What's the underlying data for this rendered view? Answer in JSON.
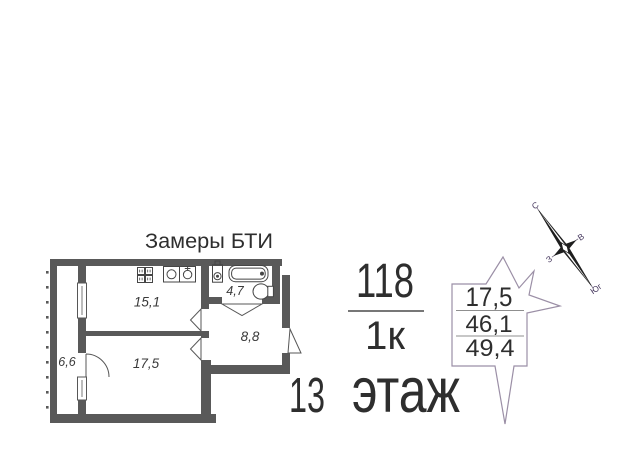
{
  "header": {
    "title": "Замеры БТИ"
  },
  "apartment": {
    "number": "118",
    "layout": "1к",
    "floor_number": "13",
    "floor_word": "этаж"
  },
  "rooms": {
    "kitchen_area": "15,1",
    "living_area": "17,5",
    "hall_area": "8,8",
    "bathroom_area": "4,7",
    "balcony_area": "6,6"
  },
  "area_stamp": {
    "living_area": "17,5",
    "apartment_area": "46,1",
    "total_area": "49,4"
  },
  "compass": {
    "north": "С",
    "east": "В",
    "west": "З",
    "south": "Юг"
  },
  "colors": {
    "wall": "#595959",
    "ink": "#2e2e2e",
    "room_label": "#3a3a3a",
    "fixture": "#454545",
    "stamp_outline": "#9b8fa6",
    "stamp_line": "#8f8f8f",
    "compass_needle": "#1e1e1e",
    "compass_label": "#483a60"
  }
}
